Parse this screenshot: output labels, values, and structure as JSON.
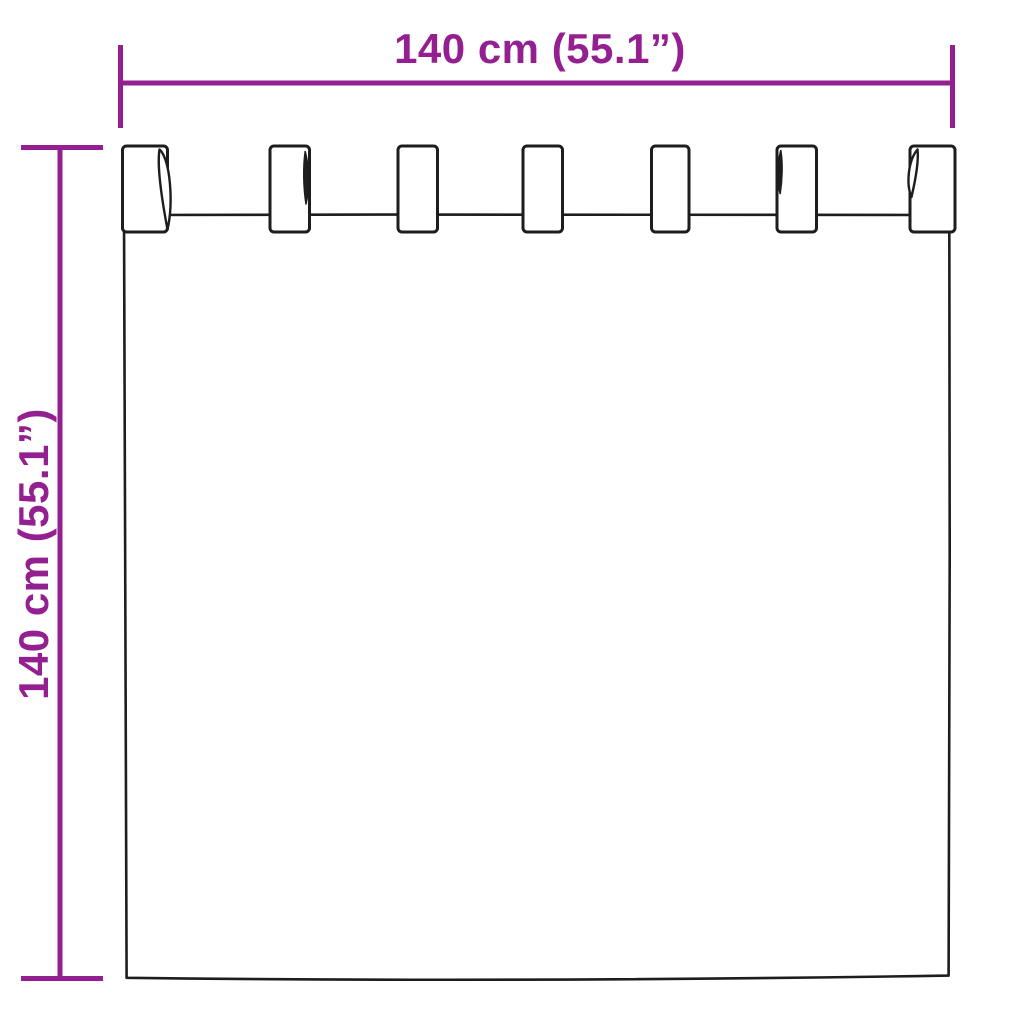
{
  "page": {
    "background": "#ffffff"
  },
  "colors": {
    "background": "#ffffff",
    "dimension": "#941f90",
    "outline": "#1d1d1d",
    "fill": "#ffffff"
  },
  "diagram": {
    "type": "product-dimension-diagram",
    "subject": "tab-top-curtain",
    "tab_count": 7
  },
  "dimensions": {
    "width": {
      "label": "140 cm (55.1”)"
    },
    "height": {
      "label": "140 cm (55.1”)"
    }
  }
}
